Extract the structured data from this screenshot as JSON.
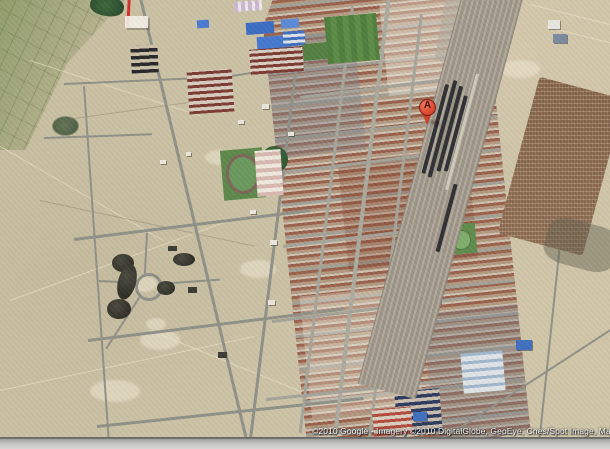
{
  "map": {
    "view_type": "satellite",
    "marker": {
      "label": "A"
    },
    "attribution": "©2010 Google - Imagery ©2010 DigitalGlobe, GeoEye, Cnes/Spot Image, Map d",
    "colors": {
      "desert_tan": "#ccc3a6",
      "farmland_green": "#80945c",
      "road_gray": "#8f9087",
      "town_roof_rust": "#9a604b",
      "field_green": "#4e7e3c",
      "railway_gray": "#9a9386",
      "train_dark": "#2e2f33",
      "pens_brown": "#8f6e52",
      "pond_olive": "#4c5c45",
      "marker_red": "#dd4a33",
      "boundary_red": "#d2302a",
      "attribution_text": "#f5f5f5",
      "window_bar_gray": "#c6c6c4"
    }
  }
}
